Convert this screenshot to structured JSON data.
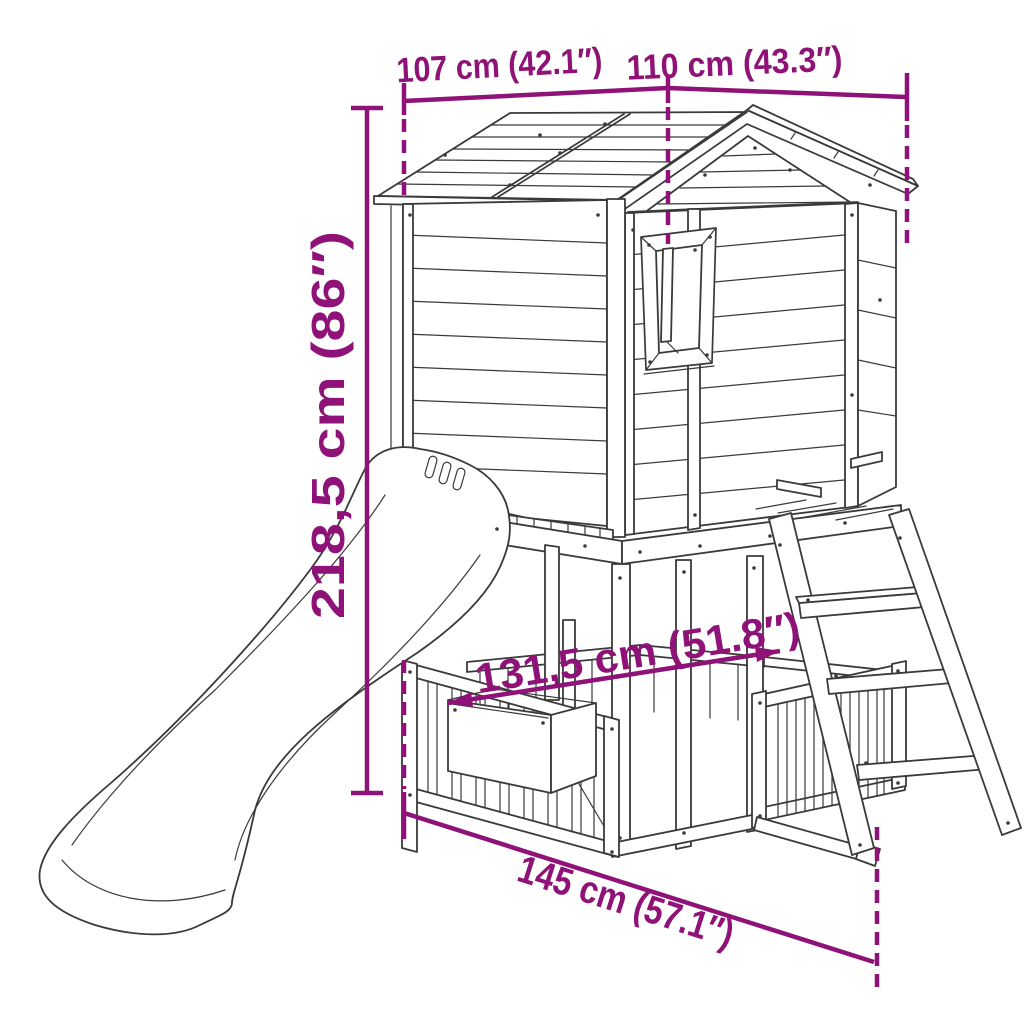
{
  "title": "Playhouse dimension diagram",
  "product": "Wooden playhouse with slide, ladder, fenced lower level and planter box",
  "style": {
    "accent_color": "#8E1277",
    "line_color": "#3A3A3A",
    "background": "#FFFFFF"
  },
  "dimensions": [
    {
      "id": "roof-depth-left",
      "label": "107 cm (42.1″)"
    },
    {
      "id": "roof-width-right",
      "label": "110 cm (43.3″)"
    },
    {
      "id": "total-height",
      "label": "218,5 cm (86″)"
    },
    {
      "id": "inner-width",
      "label": "131,5 cm (51.8″)"
    },
    {
      "id": "base-depth",
      "label": "145 cm (57.1″)"
    }
  ]
}
